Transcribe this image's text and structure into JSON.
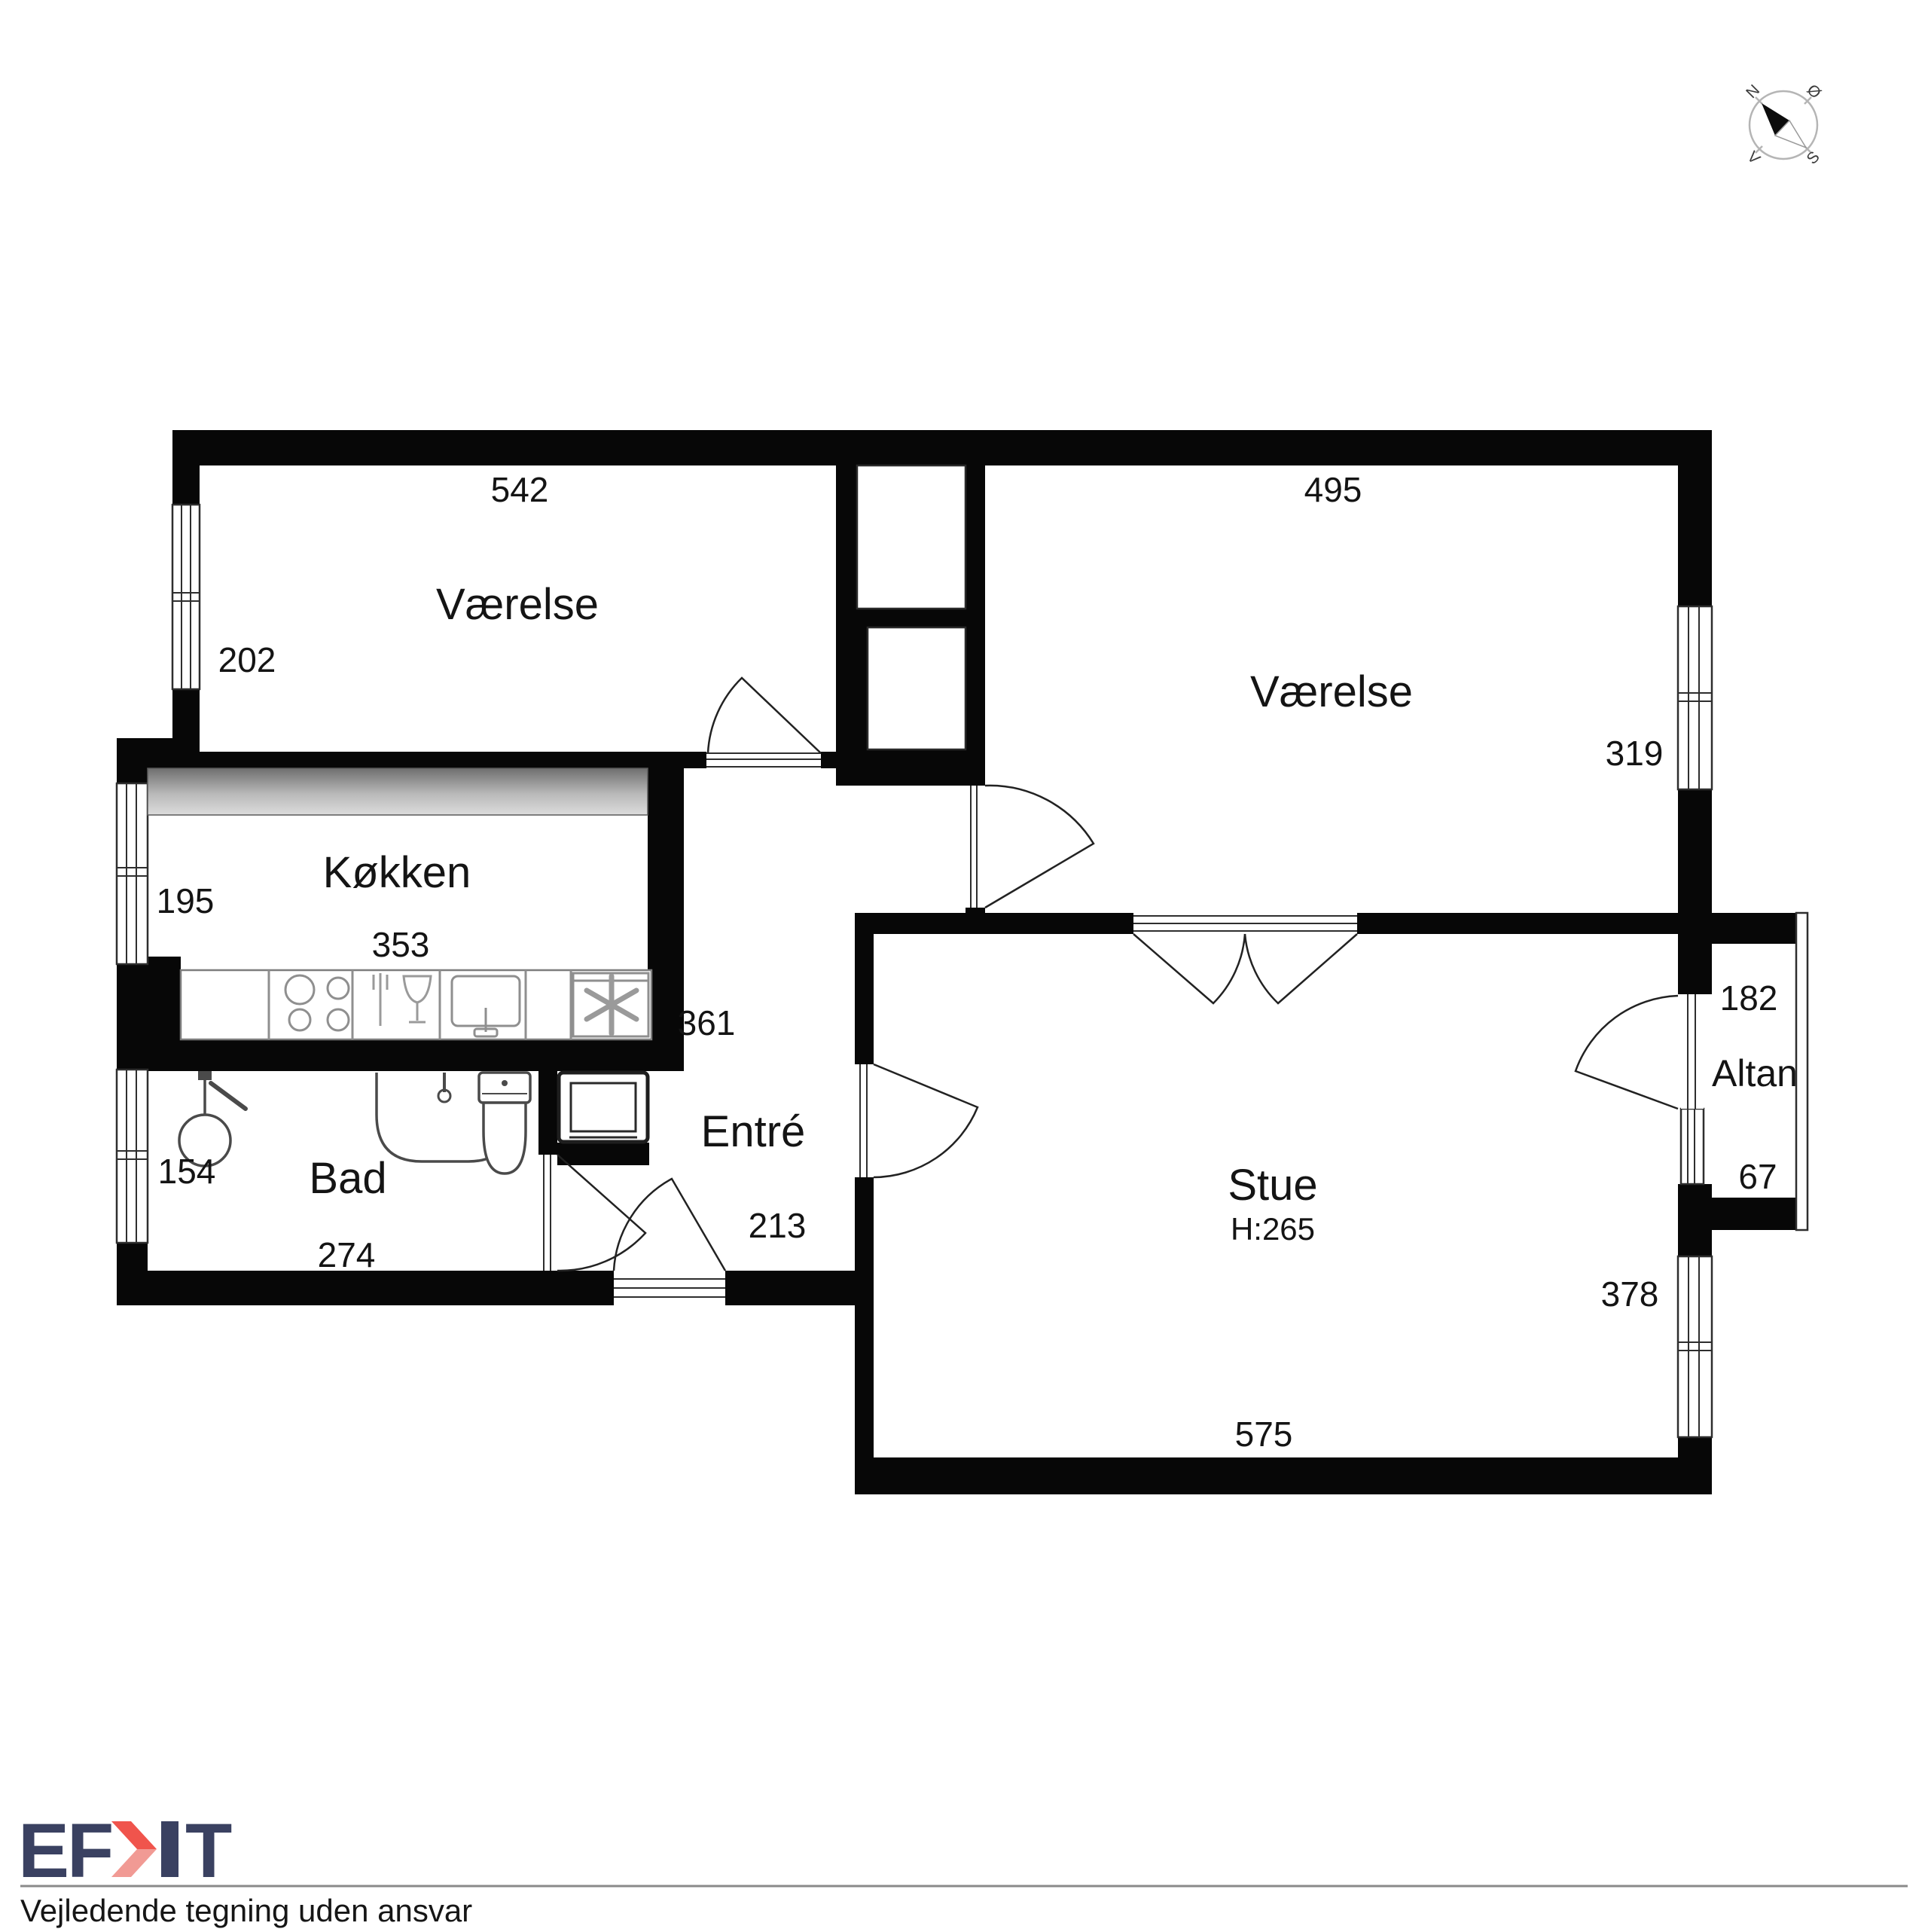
{
  "plan": {
    "compass": {
      "north": "N",
      "east": "Ø",
      "south": "S",
      "west": "V"
    },
    "rooms": [
      {
        "id": "vaerelse-1",
        "label": "Værelse",
        "dim_top": "542",
        "dim_left": "202"
      },
      {
        "id": "vaerelse-2",
        "label": "Værelse",
        "dim_top": "495",
        "dim_right": "319"
      },
      {
        "id": "koekken",
        "label": "Køkken",
        "dim_left": "195",
        "dim_bottom": "353"
      },
      {
        "id": "entre",
        "label": "Entré",
        "dim_top": "361",
        "dim_bottom": "213"
      },
      {
        "id": "bad",
        "label": "Bad",
        "dim_left": "154",
        "dim_bottom": "274"
      },
      {
        "id": "stue",
        "label": "Stue",
        "ceiling_height": "H:265",
        "dim_bottom": "575",
        "dim_right": "378"
      },
      {
        "id": "altan",
        "label": "Altan",
        "dim_top": "182",
        "dim_bottom": "67"
      }
    ]
  },
  "footer": {
    "logo": {
      "left": "EF",
      "right": "T",
      "navy": "#3a4161",
      "red": "#f0544c",
      "red_light": "#f19a94"
    },
    "disclaimer": "Vejledende tegning uden ansvar"
  }
}
